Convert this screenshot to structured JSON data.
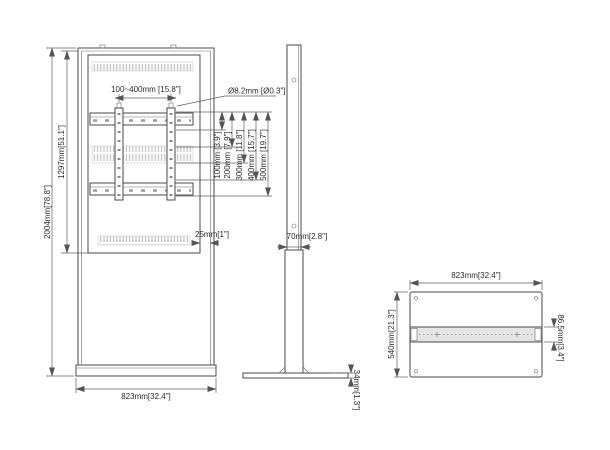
{
  "colors": {
    "line": "#4a4a4a",
    "dimension": "#5f5f5f",
    "text": "#2b2b2b",
    "vent_hatch": "#b5b5b5",
    "channel_fill": "#e4e4e4"
  },
  "front_view": {
    "total_height": "2004mm[78.8\"]",
    "screen_height": "1297mm[51.1\"]",
    "vesa_width_range": "100~400mm [15.8\"]",
    "hole_diameter": "Ø8.2mm [Ø0.3\"]",
    "vesa_heights": [
      "100mm [3.9\"]",
      "200mm [7.9\"]",
      "300mm [11.8\"]",
      "400mm [15.7\"]",
      "500mm [19.7\"]"
    ],
    "edge_offset": "25mm[1\"]",
    "base_width": "823mm[32.4\"]"
  },
  "side_view": {
    "depth": "70mm[2.8\"]",
    "foot_height": "34mm[1.3\"]"
  },
  "base_view": {
    "width": "823mm[32.4\"]",
    "depth": "540mm[21.3\"]",
    "channel_height": "86.5mm[3.4\"]"
  }
}
